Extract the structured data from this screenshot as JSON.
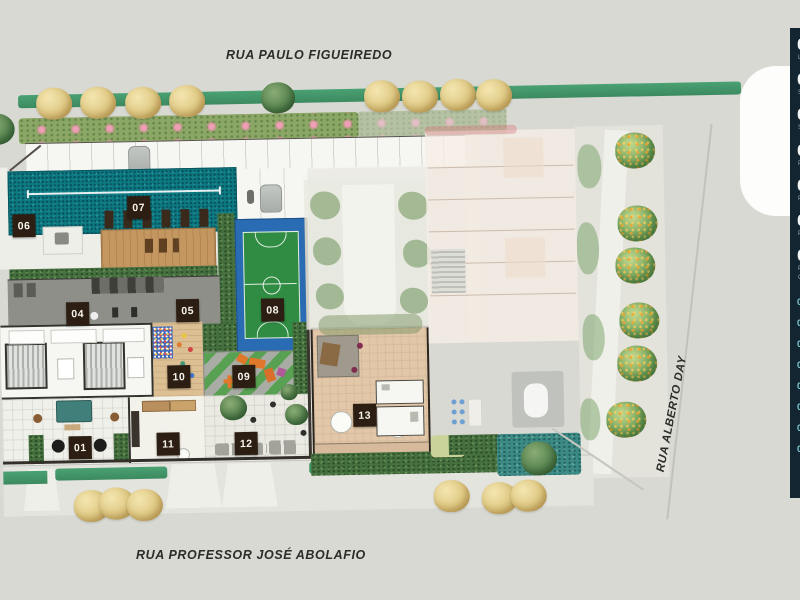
{
  "streets": {
    "top": "RUA PAULO FIGUEIREDO",
    "bottom": "RUA PROFESSOR JOSÉ ABOLAFIO",
    "right": "RUA ALBERTO DAY"
  },
  "markers": {
    "m01": "01",
    "m04": "04",
    "m05": "05",
    "m06": "06",
    "m07": "07",
    "m08": "08",
    "m09": "09",
    "m10": "10",
    "m11": "11",
    "m12": "12",
    "m13": "13"
  },
  "legend": {
    "items": [
      {
        "num": "0",
        "label": "L"
      },
      {
        "num": "0",
        "label": "S"
      },
      {
        "num": "0",
        "label": "S"
      },
      {
        "num": "0",
        "label": "P"
      },
      {
        "num": "0",
        "label": "P"
      },
      {
        "num": "0",
        "label": "P"
      },
      {
        "num": "0",
        "label": "P",
        "label2": "C"
      }
    ],
    "small_items": [
      "0",
      "0",
      "0",
      "0",
      "0",
      "0",
      "0",
      "0"
    ]
  },
  "colors": {
    "pool": "#0d7b84",
    "court_blue": "#2a6cb4",
    "court_green": "#2f8c42",
    "marker_bg": "#2c1e12",
    "sidebar_bg": "#132530",
    "verge_green": "#47a070",
    "deck_wood": "#c49660"
  }
}
